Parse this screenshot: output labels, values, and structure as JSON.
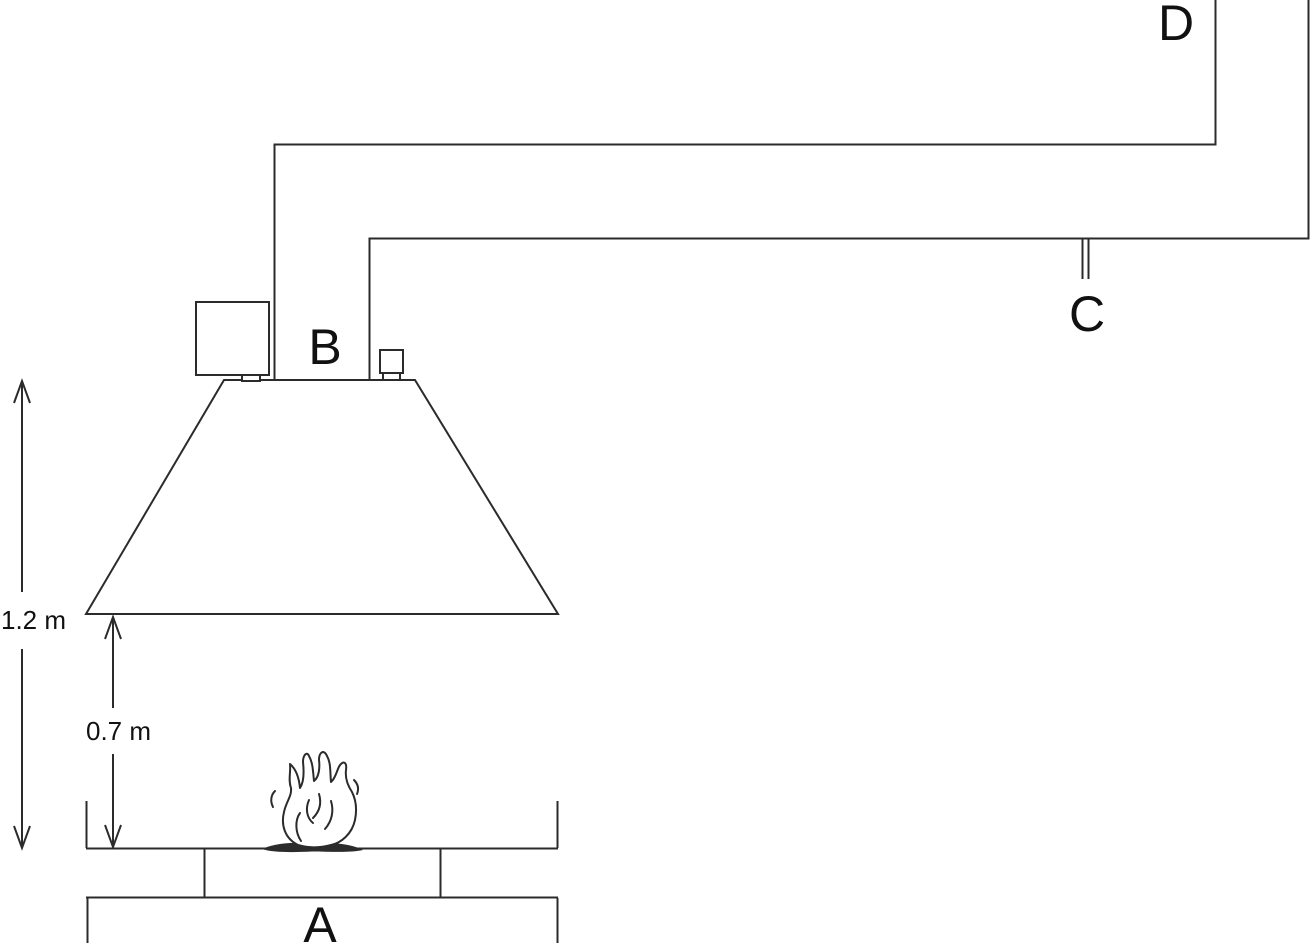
{
  "diagram": {
    "point_labels": {
      "a": "A",
      "b": "B",
      "c": "C",
      "d": "D"
    },
    "dimension_labels": {
      "table_to_hood_top": "1.2 m",
      "table_to_hood_bottom": "0.7 m"
    }
  },
  "colors": {
    "line": "#2b2b2b",
    "text": "#111111",
    "background": "#ffffff"
  }
}
